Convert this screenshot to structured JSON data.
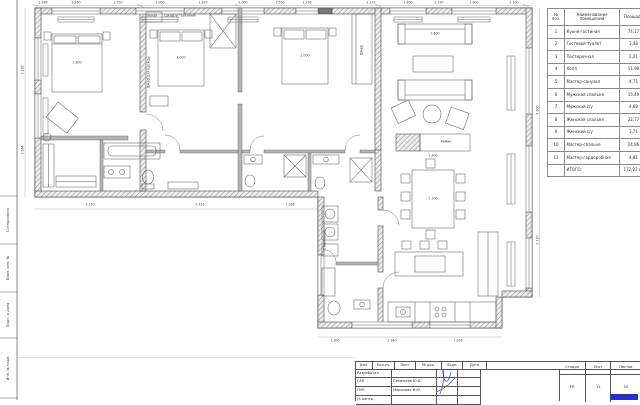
{
  "colors": {
    "accent_blue": "#2531c9",
    "wall_hatch": "#909090",
    "line": "#3f3f3f"
  },
  "frame": {
    "side_labels": [
      {
        "text": "Согласовано",
        "y": 220
      },
      {
        "text": "Взам. инв. №",
        "y": 268
      },
      {
        "text": "Подп. и дата",
        "y": 315
      },
      {
        "text": "Инв. № подл.",
        "y": 368
      }
    ]
  },
  "schedule": {
    "col_num": "№ поз.",
    "col_name": "Наименование помещений",
    "col_area": "Площадь",
    "rows": [
      {
        "num": "1",
        "name": "Кухня-гостиная",
        "area": "74,17"
      },
      {
        "num": "2",
        "name": "Гостевой туалет",
        "area": "3,48"
      },
      {
        "num": "3",
        "name": "Постирочная",
        "area": "2,01"
      },
      {
        "num": "4",
        "name": "Холл",
        "area": "11,98"
      },
      {
        "num": "5",
        "name": "Мастер-санузел",
        "area": "4,71"
      },
      {
        "num": "6",
        "name": "Мужская спальня",
        "area": "15,49"
      },
      {
        "num": "7",
        "name": "Мужской с/у",
        "area": "4,88"
      },
      {
        "num": "8",
        "name": "Женская спальня",
        "area": "22,77"
      },
      {
        "num": "9",
        "name": "Женский с/у",
        "area": "3,71"
      },
      {
        "num": "10",
        "name": "Мастер-спальня",
        "area": "24,86"
      },
      {
        "num": "11",
        "name": "Мастер-гардеробная",
        "area": "4,81"
      }
    ],
    "total_label": "ИТОГО:",
    "total_value": "172,22 м²"
  },
  "titleblock": {
    "cols": [
      "Изм.",
      "Кол.уч.",
      "Лист",
      "№ док.",
      "Подп.",
      "Дата"
    ],
    "roles": [
      {
        "role": "Разработал",
        "name": ""
      },
      {
        "role": "ГАП",
        "name": "Семенова Ю.Б."
      },
      {
        "role": "ГИП",
        "name": "Морозова И.Ю."
      },
      {
        "role": "Н. контр.",
        "name": ""
      }
    ],
    "stage_label": "Стадия",
    "sheet_label": "Лист",
    "sheets_label": "Листов",
    "stage": "РП",
    "sheet": "15",
    "sheets": "34"
  },
  "plan": {
    "labels": [
      {
        "text": "Пенал",
        "x": 152,
        "y": 16
      },
      {
        "text": "Шкаф встроенный",
        "x": 180,
        "y": 16
      },
      {
        "text": "Шкаф для одежды",
        "x": 149,
        "y": 72,
        "rot": true
      },
      {
        "text": "Шкаф",
        "x": 362,
        "y": 50,
        "rot": true
      },
      {
        "text": "Камин",
        "x": 446,
        "y": 142
      },
      {
        "text": "Стиральная",
        "x": 325,
        "y": 240,
        "rot": true
      }
    ],
    "dims": [
      {
        "text": "1.286",
        "x": 43,
        "y": 2.5
      },
      {
        "text": "2.260",
        "x": 76,
        "y": 2.5
      },
      {
        "text": "1.550",
        "x": 118,
        "y": 2.5
      },
      {
        "text": "2.000",
        "x": 160,
        "y": 2.5
      },
      {
        "text": "1.820",
        "x": 203,
        "y": 2.5
      },
      {
        "text": "2.000",
        "x": 243,
        "y": 2.5
      },
      {
        "text": "1.550",
        "x": 280,
        "y": 2.5
      },
      {
        "text": "1.236",
        "x": 307,
        "y": 2.5
      },
      {
        "text": "2.232",
        "x": 371,
        "y": 2.5
      },
      {
        "text": "1.800",
        "x": 408,
        "y": 2.5
      },
      {
        "text": "1.530",
        "x": 439,
        "y": 2.5
      },
      {
        "text": "1.800",
        "x": 474,
        "y": 2.5
      },
      {
        "text": "2.100",
        "x": 514,
        "y": 2.5
      },
      {
        "text": "2.236",
        "x": 23,
        "y": 70,
        "rot": true
      },
      {
        "text": "3.164",
        "x": 23,
        "y": 150,
        "rot": true
      },
      {
        "text": "4.800",
        "x": 537.5,
        "y": 110,
        "rot": true
      },
      {
        "text": "5.130",
        "x": 537.5,
        "y": 240,
        "rot": true
      },
      {
        "text": "3.130",
        "x": 90,
        "y": 205
      },
      {
        "text": "2.416",
        "x": 200,
        "y": 205
      },
      {
        "text": "1.286",
        "x": 290,
        "y": 205
      },
      {
        "text": "1.300",
        "x": 335,
        "y": 341
      },
      {
        "text": "2.940",
        "x": 392,
        "y": 341
      },
      {
        "text": "1.836",
        "x": 458,
        "y": 341
      },
      {
        "text": "1.800",
        "x": 77,
        "y": 63
      },
      {
        "text": "2.000",
        "x": 181,
        "y": 58
      },
      {
        "text": "2.000",
        "x": 305,
        "y": 56
      },
      {
        "text": "2.400",
        "x": 435,
        "y": 34
      },
      {
        "text": "1.400",
        "x": 433,
        "y": 156
      },
      {
        "text": "2.100",
        "x": 433,
        "y": 199
      }
    ]
  }
}
